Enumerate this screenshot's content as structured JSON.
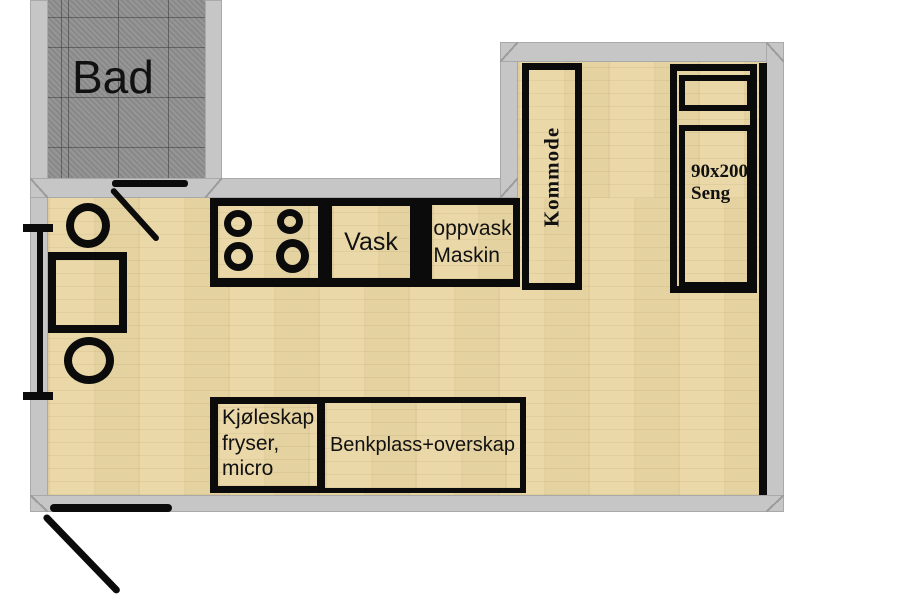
{
  "labels": {
    "bathroom": "Bad",
    "sink": "Vask",
    "dishwasher_line1": "oppvask",
    "dishwasher_line2": "Maskin",
    "dresser": "Kommode",
    "bed_line1": "90x200",
    "bed_line2": "Seng",
    "fridge_line1": "Kjøleskap",
    "fridge_line2": "fryser,",
    "fridge_line3": "micro",
    "bench": "Benkplass+overskap"
  },
  "colors": {
    "floor_wood": "#e9d6a4",
    "wall_gray": "#c6c6c6",
    "bathroom_tile": "#8f8f8f",
    "line_black": "#0b0b0b"
  }
}
